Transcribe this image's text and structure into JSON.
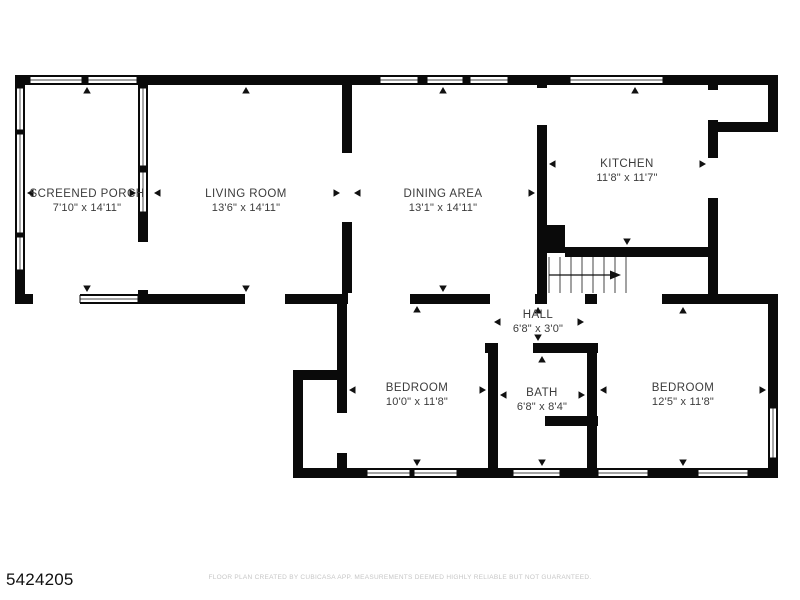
{
  "listing_id": "5424205",
  "footer": {
    "disclaimer": "FLOOR PLAN CREATED BY CUBICASA APP. MEASUREMENTS DEEMED HIGHLY RELIABLE BUT NOT GUARANTEED."
  },
  "floor_plan": {
    "type": "floor-plan",
    "colors": {
      "walls": "#0a0a0a",
      "background": "#ffffff",
      "room_label_text": "#3b3b3b",
      "disclaimer_text": "#c6c6c6"
    },
    "rooms": [
      {
        "name": "SCREENED PORCH",
        "dimensions": "7'10\" x 14'11\""
      },
      {
        "name": "LIVING ROOM",
        "dimensions": "13'6\" x 14'11\""
      },
      {
        "name": "DINING AREA",
        "dimensions": "13'1\" x 14'11\""
      },
      {
        "name": "KITCHEN",
        "dimensions": "11'8\" x 11'7\""
      },
      {
        "name": "HALL",
        "dimensions": "6'8\" x 3'0\""
      },
      {
        "name": "BEDROOM",
        "dimensions": "10'0\" x 11'8\""
      },
      {
        "name": "BATH",
        "dimensions": "6'8\" x 8'4\""
      },
      {
        "name": "BEDROOM",
        "dimensions": "12'5\" x 11'8\""
      }
    ]
  }
}
